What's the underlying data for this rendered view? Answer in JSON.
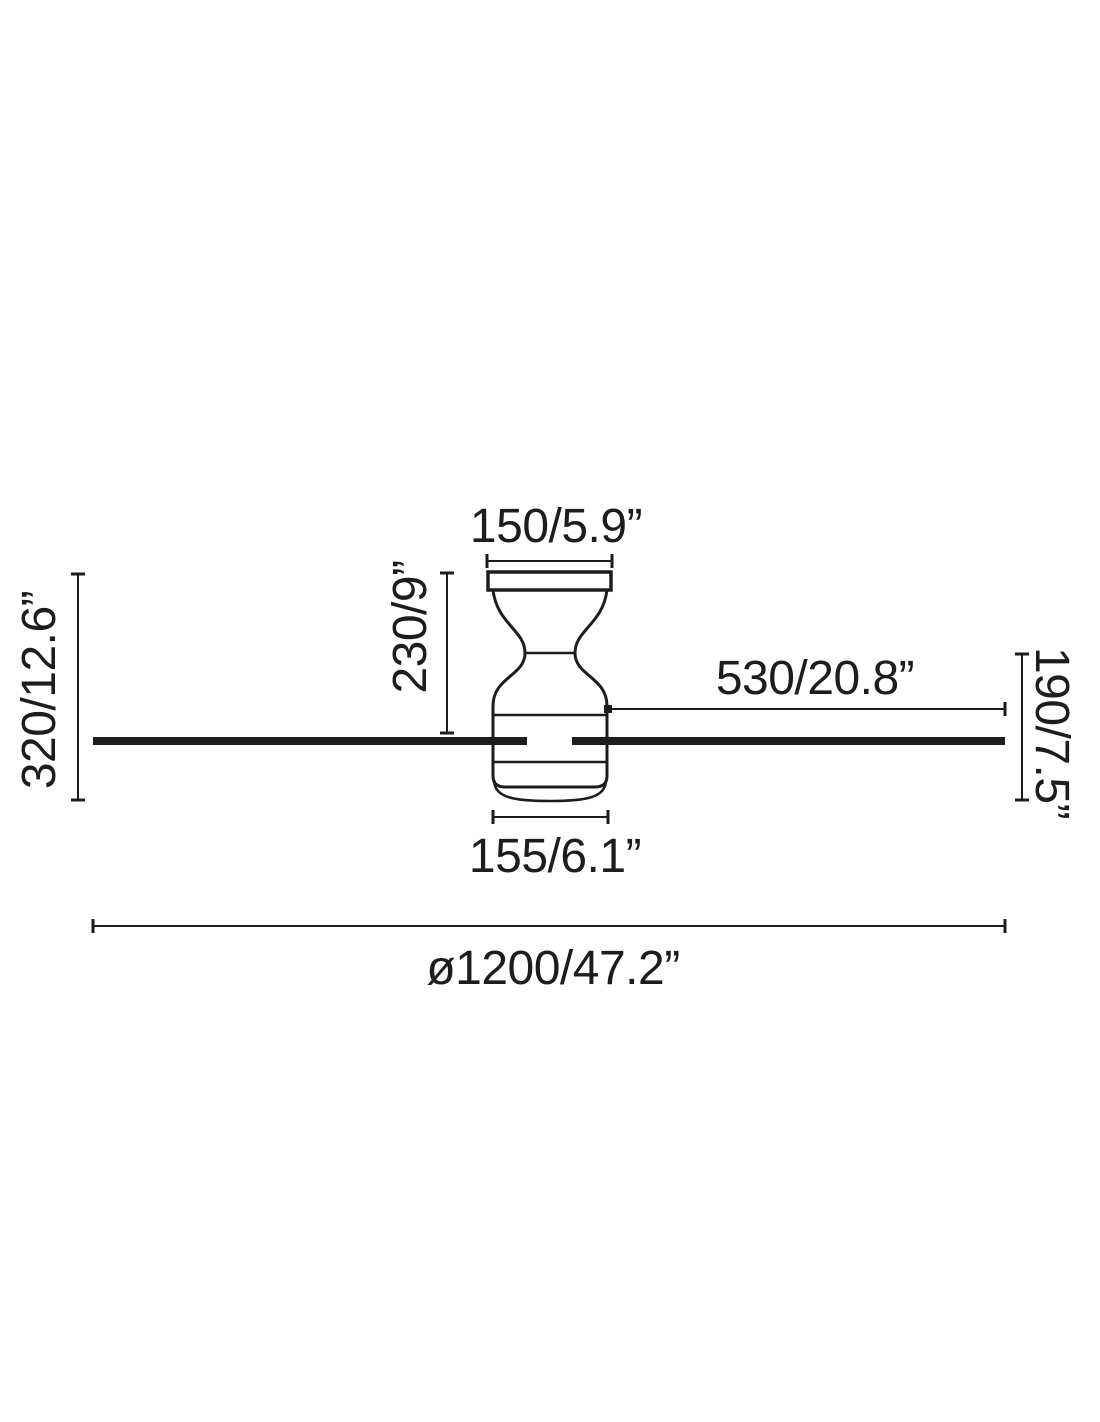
{
  "diagram": {
    "kind": "ceiling-fan-dimension-drawing",
    "view": "side elevation",
    "units": "mm/inches"
  },
  "colors": {
    "ink": "#1d1d1b",
    "background": "#ffffff"
  },
  "labels": {
    "canopy_width": "150/5.9”",
    "drop_to_blades": "230/9”",
    "ceiling_to_bottom": "320/12.6”",
    "blade_length": "530/20.8”",
    "housing_height": "190/7.5”",
    "housing_width": "155/6.1”",
    "sweep_diameter": "ø1200/47.2”"
  }
}
